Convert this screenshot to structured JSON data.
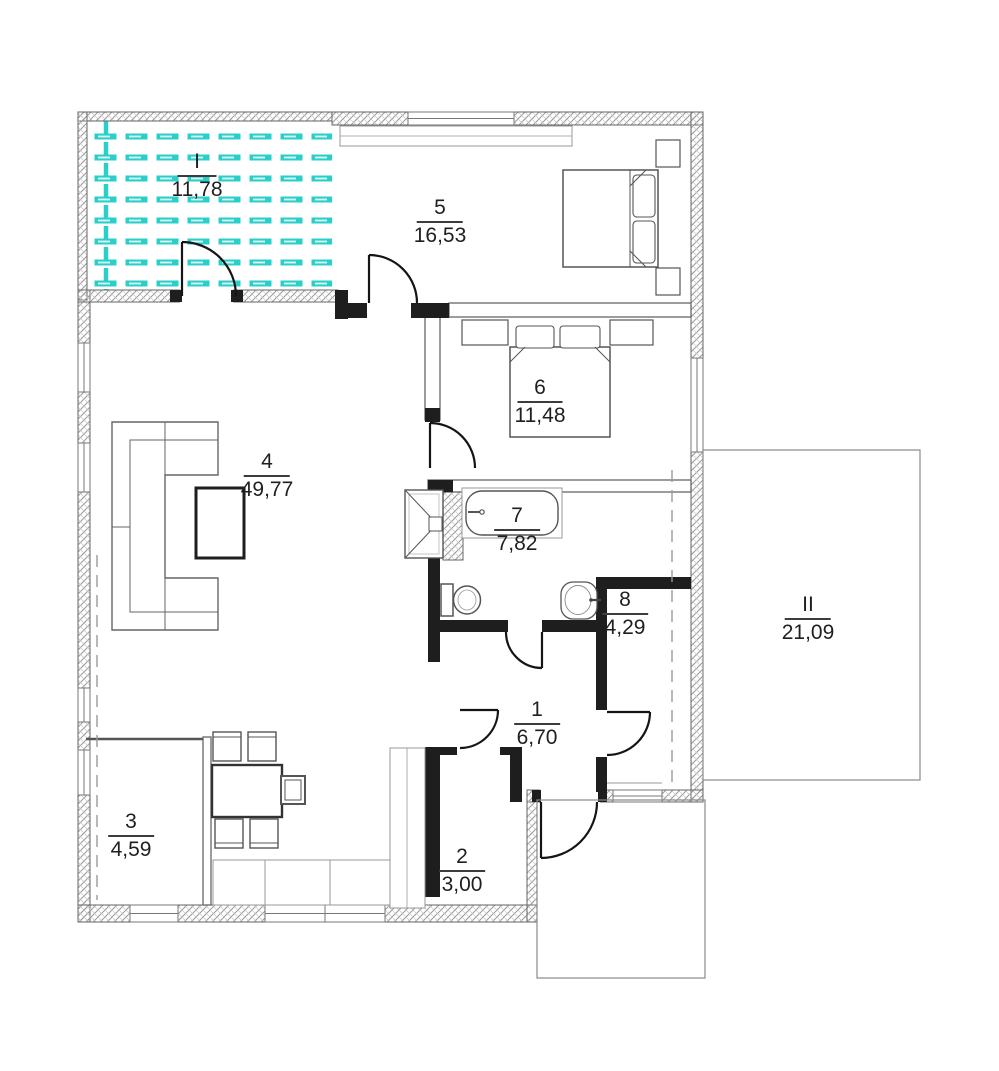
{
  "plan": {
    "rooms": [
      {
        "id": "I",
        "area": "11,78"
      },
      {
        "id": "5",
        "area": "16,53"
      },
      {
        "id": "6",
        "area": "11,48"
      },
      {
        "id": "4",
        "area": "49,77"
      },
      {
        "id": "7",
        "area": "7,82"
      },
      {
        "id": "8",
        "area": "4,29"
      },
      {
        "id": "II",
        "area": "21,09"
      },
      {
        "id": "1",
        "area": "6,70"
      },
      {
        "id": "2",
        "area": "3,00"
      },
      {
        "id": "3",
        "area": "4,59"
      }
    ],
    "colors": {
      "deck_hatch": "#2bcfc9",
      "wall_dark": "#1e1e1e",
      "wall_hatch_line": "#9a9a9a"
    }
  }
}
